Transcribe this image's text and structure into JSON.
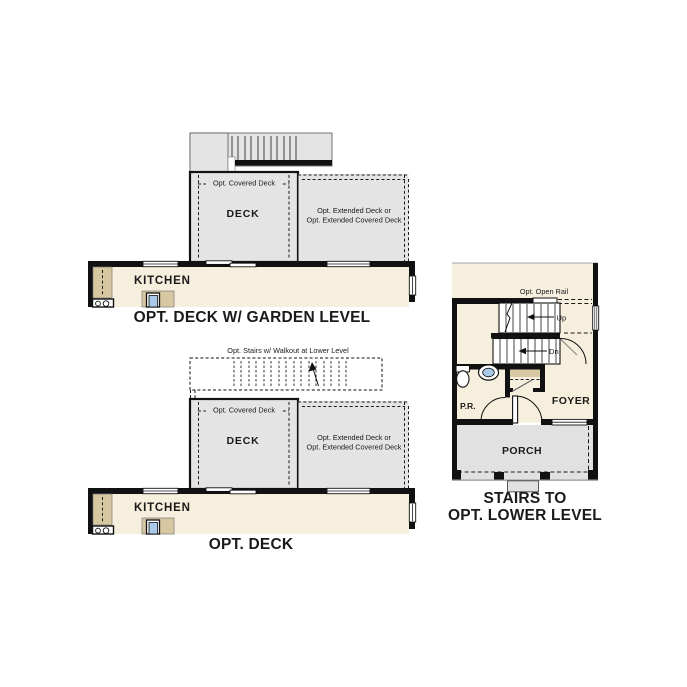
{
  "colors": {
    "cream_floor": "#f7efdd",
    "deck_gray": "#e4e4e4",
    "porch_gray": "#e1e1e1",
    "cabinet_tan": "#d7c8a2",
    "sink_blue": "#a9c9e9",
    "wall_black": "#111111"
  },
  "garden_level": {
    "title": "OPT. DECK W/ GARDEN LEVEL",
    "covered_deck_label": "Opt. Covered Deck",
    "deck_label": "DECK",
    "extended_deck_line1": "Opt. Extended Deck or",
    "extended_deck_line2": "Opt. Extended Covered Deck",
    "kitchen_label": "KITCHEN"
  },
  "opt_deck": {
    "title": "OPT. DECK",
    "stairs_note": "Opt. Stairs w/ Walkout at Lower Level",
    "covered_deck_label": "Opt. Covered Deck",
    "deck_label": "DECK",
    "extended_deck_line1": "Opt. Extended Deck or",
    "extended_deck_line2": "Opt. Extended Covered Deck",
    "kitchen_label": "KITCHEN"
  },
  "lower_level": {
    "title_line1": "STAIRS TO",
    "title_line2": "OPT. LOWER LEVEL",
    "open_rail_label": "Opt. Open Rail",
    "up_label": "Up",
    "down_label": "Dn",
    "powder_room_label": "P.R.",
    "foyer_label": "FOYER",
    "porch_label": "PORCH"
  }
}
